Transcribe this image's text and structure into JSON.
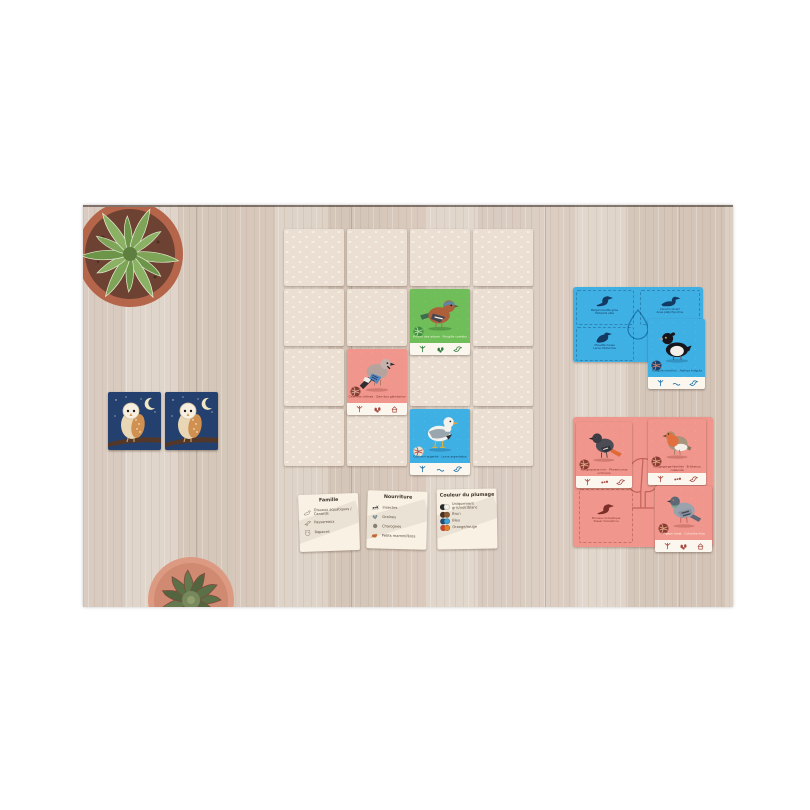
{
  "colors": {
    "card_green": "#6fbe59",
    "card_pink": "#f0968c",
    "card_blue": "#3fb0e4",
    "card_navy": "#24406e",
    "facedown": "#eadfd2",
    "legend_bg": "#f8f1e4"
  },
  "grid": {
    "facedown_count": 13,
    "cards": {
      "chaffinch": {
        "caption": "Pinson des arbres · Fringilla coelebs"
      },
      "jay": {
        "caption": "Geai des chênes · Garrulus glandarius"
      },
      "gull": {
        "caption": "Goéland argenté · Larus argentatus"
      }
    }
  },
  "blue_board": {
    "slots": [
      {
        "name": "Bergeronnette grise",
        "latin": "Motacilla alba"
      },
      {
        "name": "Canard colvert",
        "latin": "Anas platyrhynchos"
      },
      {
        "name": "Mouette rieuse",
        "latin": "Larus ridibundus"
      }
    ],
    "card": {
      "caption": "Fuligule morillon · Aythya fuligula"
    }
  },
  "pink_board": {
    "empty_slot": {
      "name": "Moineau domestique",
      "latin": "Passer domesticus"
    },
    "cards": [
      {
        "caption": "Rougequeue noir · Phoenicurus ochruros"
      },
      {
        "caption": "Rougegorge familier · Erithacus rubecula"
      },
      {
        "caption": "Pigeon biset · Columba livia"
      }
    ]
  },
  "legend": {
    "famille": {
      "title": "Famille",
      "items": [
        {
          "label": "Oiseaux aquatiques / Canards"
        },
        {
          "label": "Passereaux"
        },
        {
          "label": "Rapaces"
        }
      ]
    },
    "nourriture": {
      "title": "Nourriture",
      "items": [
        {
          "label": "Insectes"
        },
        {
          "label": "Graines"
        },
        {
          "label": "Charognes"
        },
        {
          "label": "Petits mammifères"
        }
      ]
    },
    "plumage": {
      "title": "Couleur du plumage",
      "items": [
        {
          "label": "Uniquement gris/noir/blanc",
          "c1": "#2a2a2a",
          "c2": "#f3f1ea"
        },
        {
          "label": "Brun",
          "c1": "#4a3120",
          "c2": "#8a5b33"
        },
        {
          "label": "Bleu",
          "c1": "#1d4e7e",
          "c2": "#3fa3d6"
        },
        {
          "label": "Orange/rouge",
          "c1": "#d5402b",
          "c2": "#e58026"
        }
      ]
    }
  }
}
